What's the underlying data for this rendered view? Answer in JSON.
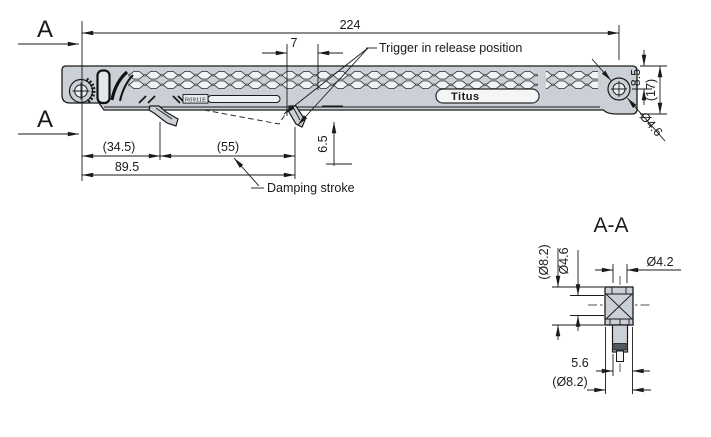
{
  "drawing": {
    "type": "technical-dimension-drawing",
    "section_marker": "A",
    "section_title": "A-A",
    "brand": "Titus",
    "part_marking": "R0911E",
    "labels": {
      "trigger": "Trigger in release position",
      "damping": "Damping stroke"
    },
    "dims": {
      "overall_length": "224",
      "trigger_offset": "7",
      "left_offset": "(34.5)",
      "damping_stroke": "(55)",
      "total_travel": "89.5",
      "trigger_drop": "6.5",
      "top_to_hole_center": "8.5",
      "total_height": "(17)",
      "hole_dia": "Ø4.6",
      "sec_flange_dia": "(Ø8.2)",
      "sec_core_dia": "Ø4.6",
      "sec_pin_dia": "Ø4.2",
      "sec_offset": "5.6",
      "sec_outer_dia": "(Ø8.2)"
    },
    "colors": {
      "part_fill": "#cbd0d6",
      "cell_fill": "#f1f3f5",
      "line": "#1a1a1a"
    }
  }
}
